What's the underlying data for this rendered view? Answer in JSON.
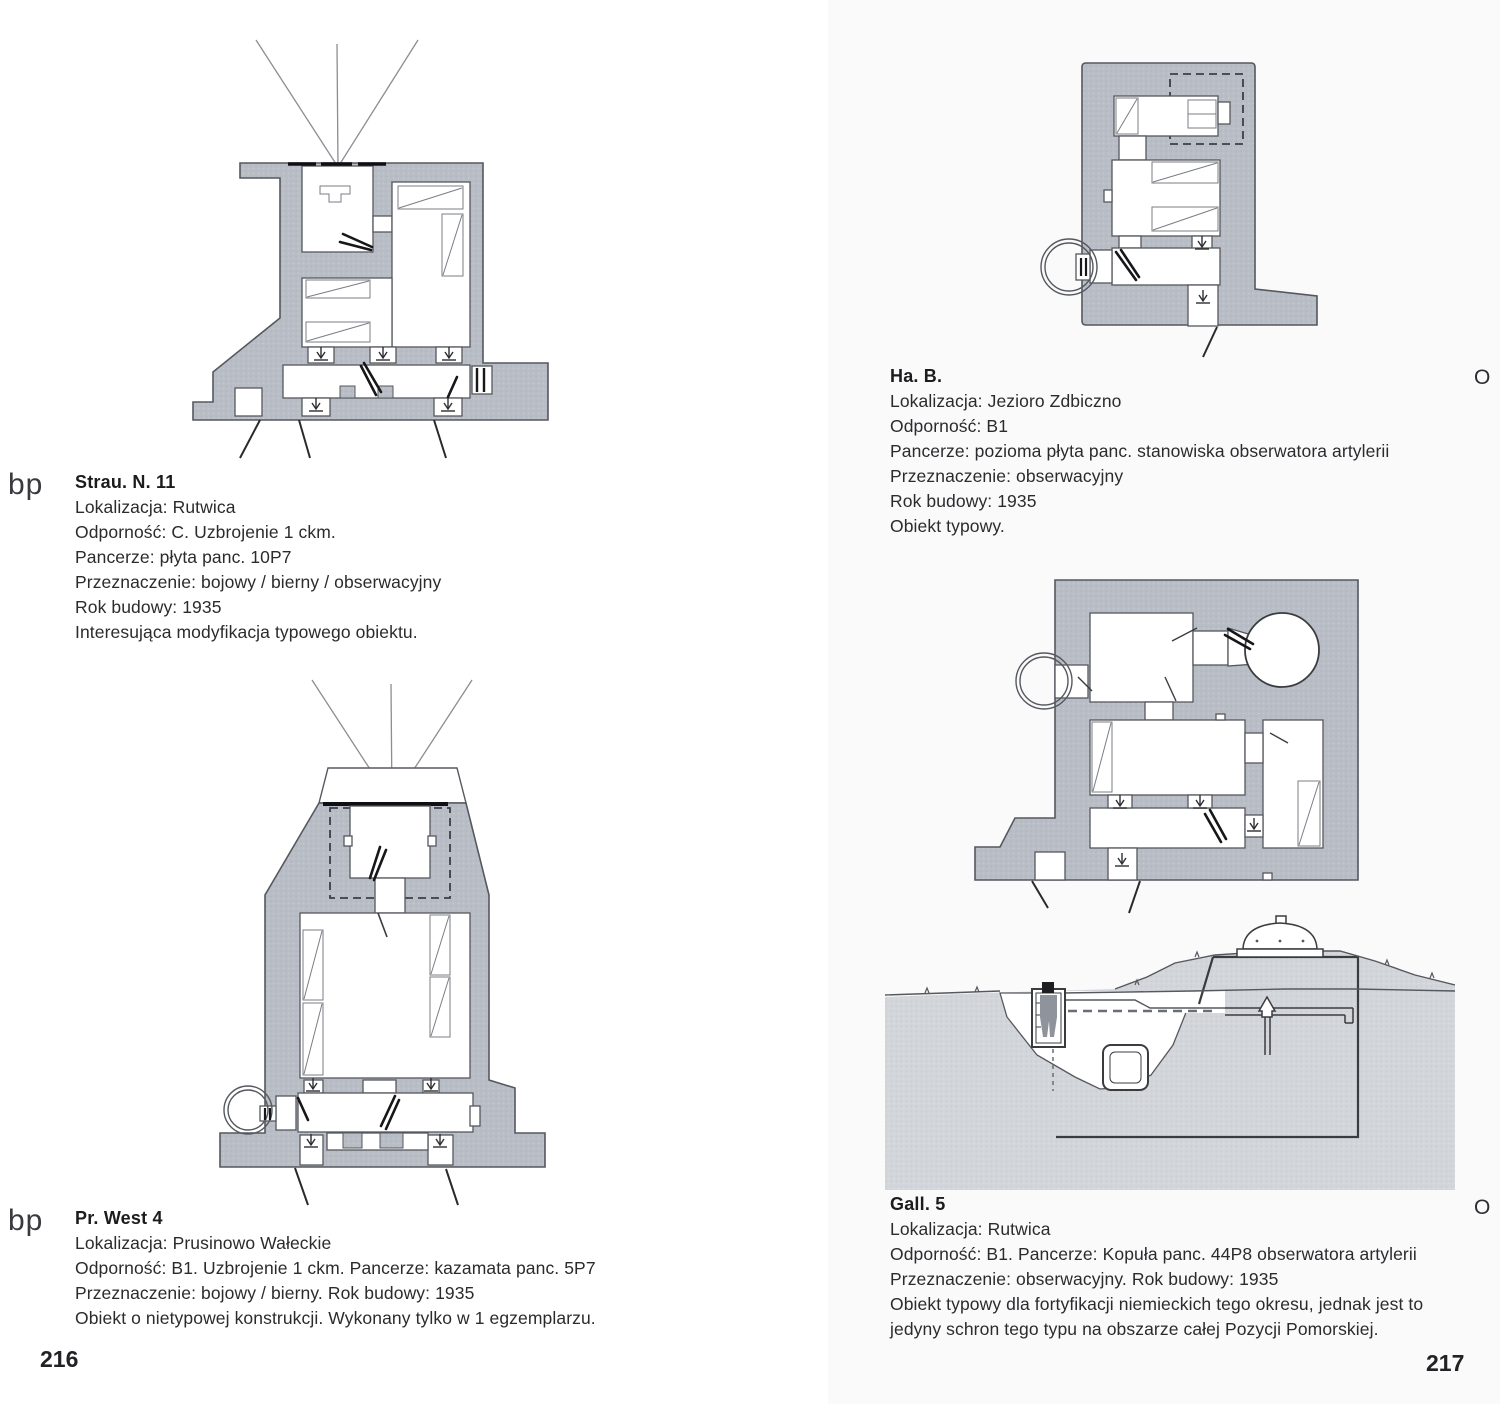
{
  "book": {
    "left_page": {
      "page_number": "216",
      "entries": [
        {
          "margin_label": "bp",
          "title": "Strau. N. 11",
          "lines": [
            "Lokalizacja: Rutwica",
            "Odporność: C. Uzbrojenie 1 ckm.",
            "Pancerze: płyta panc. 10P7",
            "Przeznaczenie: bojowy / bierny / obserwacyjny",
            "Rok budowy: 1935",
            "Interesująca modyfikacja typowego obiektu."
          ]
        },
        {
          "margin_label": "bp",
          "title": "Pr. West 4",
          "lines": [
            "Lokalizacja: Prusinowo Wałeckie",
            "Odporność: B1. Uzbrojenie 1 ckm. Pancerze: kazamata panc. 5P7",
            "Przeznaczenie: bojowy / bierny. Rok budowy: 1935",
            "Obiekt o nietypowej konstrukcji. Wykonany tylko w 1 egzemplarzu."
          ]
        }
      ]
    },
    "right_page": {
      "page_number": "217",
      "entries": [
        {
          "margin_label": "O",
          "title": "Ha. B.",
          "lines": [
            "Lokalizacja: Jezioro Zdbiczno",
            "Odporność: B1",
            "Pancerze: pozioma płyta panc. stanowiska obserwatora artylerii",
            "Przeznaczenie: obserwacyjny",
            "Rok budowy: 1935",
            "Obiekt typowy."
          ]
        },
        {
          "margin_label": "O",
          "title": "Gall. 5",
          "lines": [
            "Lokalizacja: Rutwica",
            "Odporność: B1. Pancerze: Kopuła panc. 44P8 obserwatora artylerii",
            "Przeznaczenie: obserwacyjny. Rok budowy: 1935",
            "Obiekt typowy dla fortyfikacji niemieckich tego okresu, jednak jest to",
            "jedyny schron tego typu na obszarze całej Pozycji Pomorskiej."
          ]
        }
      ]
    }
  },
  "colors": {
    "wall_gray": "#b9bec6",
    "wall_dot": "#a9aeb8",
    "earth_gray": "#d2d6da",
    "outline_ink": "#55585e",
    "arrow_ink": "#17171a",
    "paper_left": "#ffffff",
    "paper_right": "#fafafb",
    "text_ink": "#2b2b2e"
  }
}
